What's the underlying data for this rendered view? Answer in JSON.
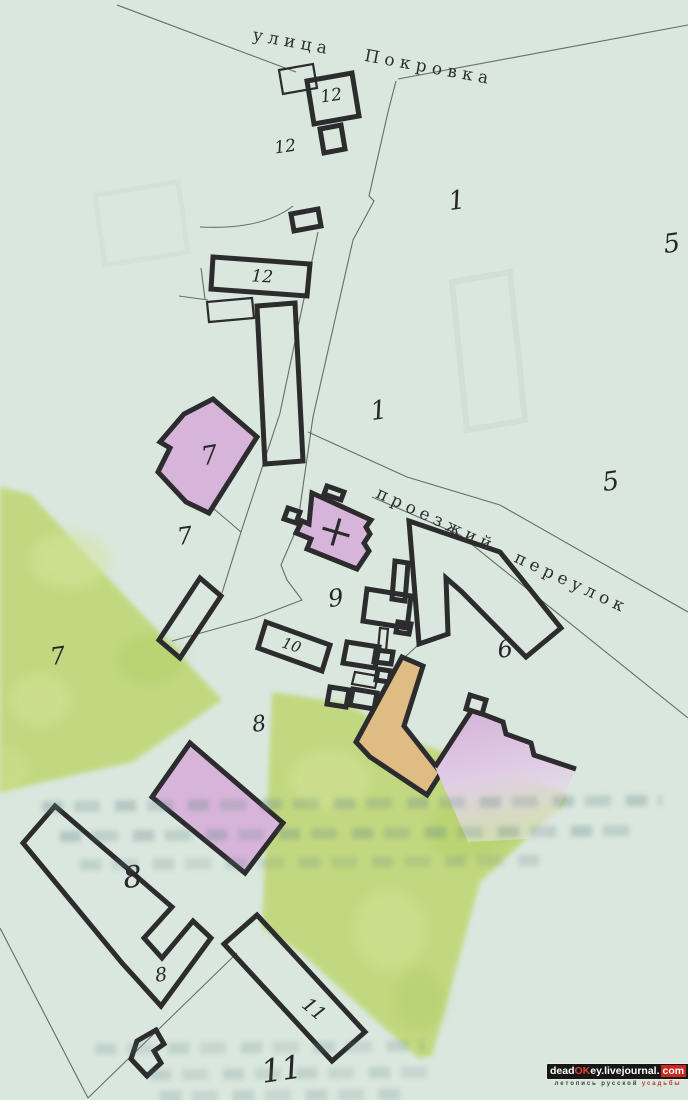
{
  "map": {
    "street_top": "улица Покровка",
    "lane_label": "проезжий переулок",
    "plot_labels": {
      "l12_top": "12",
      "l12_left": "12",
      "l12_mid": "12",
      "l1_upper": "1",
      "l1_lower": "1",
      "l5_upper": "5",
      "l5_lower": "5",
      "l7_in": "7",
      "l7_mid": "7",
      "l7_green": "7",
      "l9": "9",
      "l10": "10",
      "l6": "6",
      "l8_top": "8",
      "l8_big": "8",
      "l8_small": "8",
      "l11_in": "11",
      "l11_big": "11"
    },
    "colors": {
      "paper": "#d9e7de",
      "garden_green": "#c1d87c",
      "building_lilac": "#d7b4d9",
      "barn_orange": "#dfbc83",
      "outline_dark": "#2c2c2e",
      "road_line": "#50594f"
    }
  },
  "watermark": {
    "p1": "dead",
    "p2": "OK",
    "p3": "ey",
    "p4": ".livejournal.",
    "p5": "com",
    "sub1": "летопись русской",
    "sub2": "усадьбы"
  }
}
